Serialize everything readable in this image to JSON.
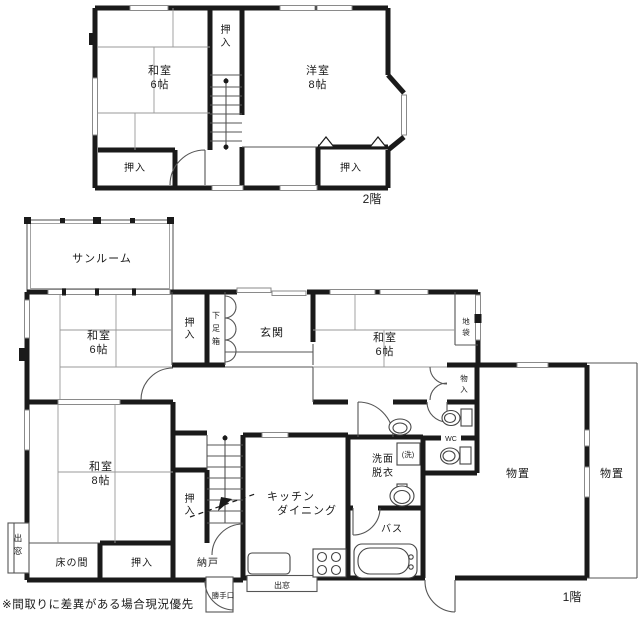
{
  "colors": {
    "wall": "#1a1a1a",
    "window": "#8a8a8a",
    "background": "#ffffff"
  },
  "floor2": {
    "label": "2階",
    "rooms": {
      "washitsu6": {
        "l1": "和室",
        "l2": "6帖"
      },
      "yoshitsu8": {
        "l1": "洋室",
        "l2": "8帖"
      },
      "oshiire_top": "押入",
      "oshiire_left": "押入",
      "oshiire_right": "押入"
    }
  },
  "floor1": {
    "label": "1階",
    "rooms": {
      "sunroom": "サンルーム",
      "washitsu6_west": {
        "l1": "和室",
        "l2": "6帖"
      },
      "oshiire_entry": "押入",
      "getabako": "下足箱",
      "genkan": "玄関",
      "washitsu6_east": {
        "l1": "和室",
        "l2": "6帖"
      },
      "jibukuro": "地袋",
      "monoire": "物入",
      "washitsu8": {
        "l1": "和室",
        "l2": "8帖"
      },
      "oshiire_stair": "押入",
      "tokonoma": "床の間",
      "oshiire_south": "押入",
      "nando": "納戸",
      "katteguchi": "勝手口",
      "demado_south": "出窓",
      "demado_west": "出窓",
      "kitchen": {
        "l1": "キッチン",
        "l2": "ダイニング"
      },
      "senmen": {
        "l1": "洗面",
        "l2": "脱衣"
      },
      "laundry": "(洗)",
      "bath": "バス",
      "wc": "WC",
      "monooki": "物置",
      "monooki_east": "物置"
    }
  },
  "note": "※間取りに差異がある場合現況優先"
}
